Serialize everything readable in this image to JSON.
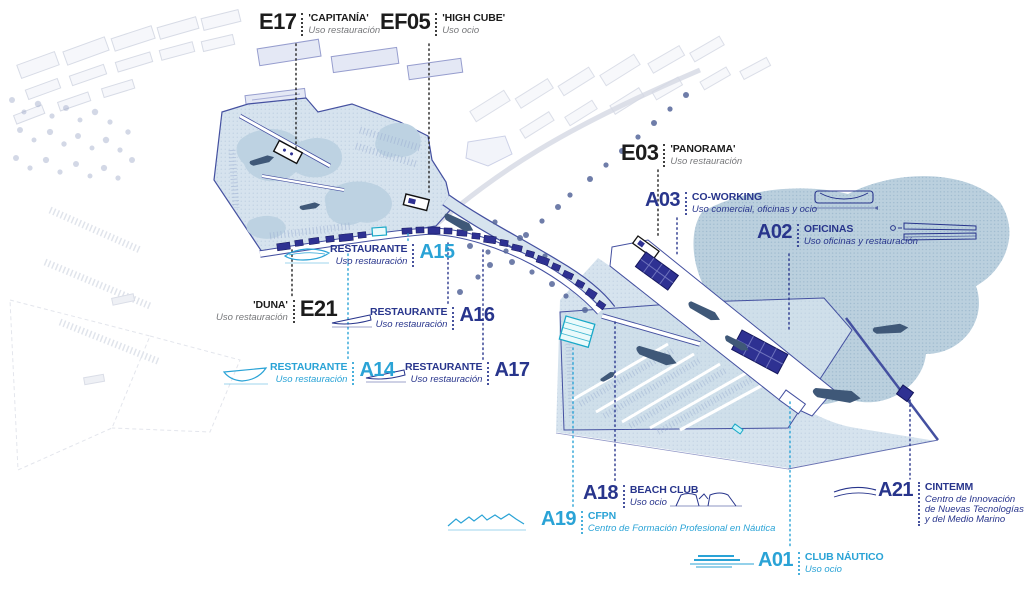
{
  "title": "Port marina development site plan",
  "colors": {
    "label_black": "#1c1c1c",
    "label_navy": "#28358c",
    "label_cyan": "#2aa3d6",
    "desc_gray": "#77787b",
    "water_light": "#d6e3ee",
    "water_wave": "#bdd2e2",
    "sea": "#b7cddc",
    "map_line": "#4450a0",
    "building_navy": "#2e3192",
    "building_teal": "#18a8c8",
    "ship": "#3f5878"
  },
  "labels": [
    {
      "code": "E17",
      "name": "'CAPITANÍA'",
      "desc": "Uso restauración",
      "color": "black",
      "sketch": null
    },
    {
      "code": "EF05",
      "name": "'HIGH CUBE'",
      "desc": "Uso ocio",
      "color": "black",
      "sketch": null
    },
    {
      "code": "E03",
      "name": "'PANORAMA'",
      "desc": "Uso restauración",
      "color": "black",
      "sketch": null
    },
    {
      "code": "A03",
      "name": "CO-WORKING",
      "desc": "Uso comercial, oficinas y ocio",
      "color": "navy",
      "sketch": "building-section-sketch"
    },
    {
      "code": "A02",
      "name": "OFICINAS",
      "desc": "Uso oficinas y restauración",
      "color": "navy",
      "sketch": "building-plan-sketch"
    },
    {
      "code": "A15",
      "name": "RESTAURANTE",
      "desc": "Uso restauración",
      "color": "navy",
      "code_color": "cyan",
      "sketch": "boat-plan-sketch"
    },
    {
      "code": "E21",
      "name": "'DUNA'",
      "desc": "Uso restauración",
      "color": "black",
      "sketch": null
    },
    {
      "code": "A16",
      "name": "RESTAURANTE",
      "desc": "Uso restauración",
      "color": "navy",
      "sketch": "boat-plan-sketch"
    },
    {
      "code": "A14",
      "name": "RESTAURANTE",
      "desc": "Uso restauración",
      "color": "cyan",
      "sketch": "boat-plan-sketch"
    },
    {
      "code": "A17",
      "name": "RESTAURANTE",
      "desc": "Uso restauración",
      "color": "navy",
      "sketch": "boat-plan-sketch"
    },
    {
      "code": "A18",
      "name": "BEACH CLUB",
      "desc": "Uso ocio",
      "color": "navy",
      "sketch": "roof-section-sketch"
    },
    {
      "code": "A19",
      "name": "CFPN",
      "desc": "Centro de Formación Profesional en Náutica",
      "color": "cyan",
      "sketch": "sawtooth-roof-sketch"
    },
    {
      "code": "A01",
      "name": "CLUB NÁUTICO",
      "desc": "Uso ocio",
      "color": "cyan",
      "sketch": "deck-lines-sketch"
    },
    {
      "code": "A21",
      "name": "CINTEMM",
      "desc": "Centro de Innovación de Nuevas Tecnologías y del Medio Marino",
      "color": "navy",
      "sketch": "curved-roof-sketch"
    }
  ]
}
